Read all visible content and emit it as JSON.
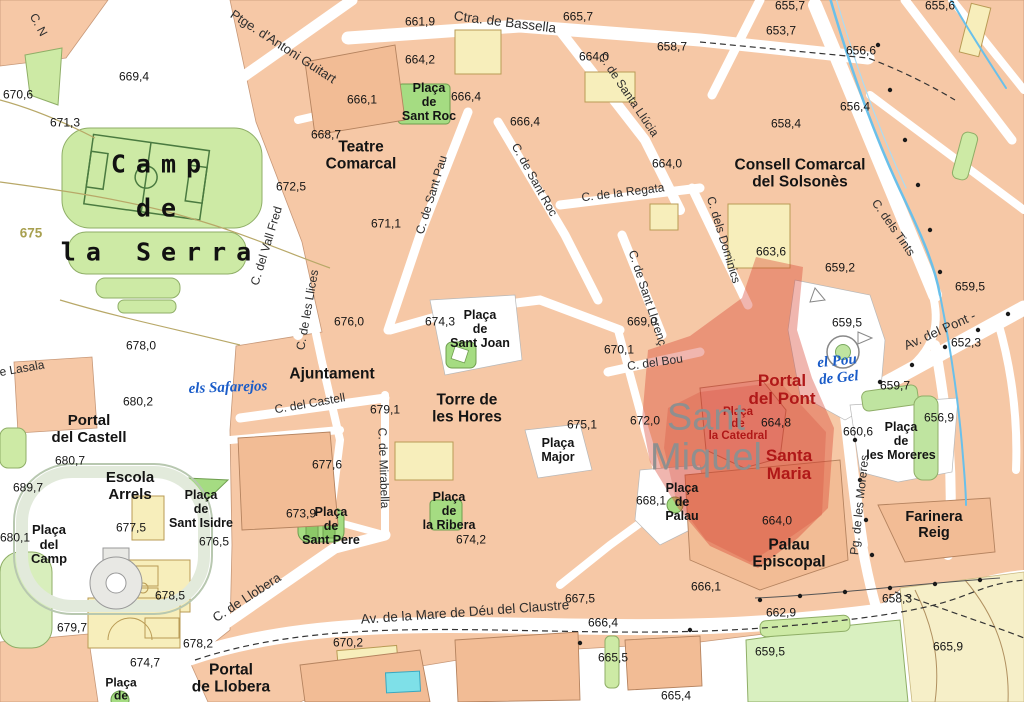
{
  "map": {
    "region_name": "Solsona old town map with highlighted cathedral area",
    "palette": {
      "block_salmon": "#f6c8a6",
      "building_yellow": "#f7eebb",
      "park_green": "#cdeaa5",
      "plaza_green": "#a5dc82",
      "water_blue": "#5fb8e8",
      "highlight_red": "#d83e2d",
      "label_red": "#b01818",
      "label_blue": "#1a5cc8",
      "label_grey": "#8f8f8f",
      "field_tan": "#f6efc8"
    },
    "highlight_label": {
      "lines": [
        "Sant",
        "Miquel"
      ],
      "x": 706,
      "y": 438,
      "s": 38
    },
    "red_labels": [
      {
        "lines": [
          "Portal",
          "del Pont"
        ],
        "x": 782,
        "y": 390,
        "s": 17
      },
      {
        "lines": [
          "Santa",
          "Maria"
        ],
        "x": 789,
        "y": 465,
        "s": 17
      },
      {
        "lines": [
          "Plaça",
          "de",
          "la Catedral"
        ],
        "x": 738,
        "y": 424,
        "s": 11.5
      }
    ],
    "water_labels": [
      {
        "lines": [
          "els Safarejos"
        ],
        "x": 228,
        "y": 388,
        "r": -2
      },
      {
        "lines": [
          "el Pou",
          "de Gel"
        ],
        "x": 838,
        "y": 370,
        "r": -6
      }
    ],
    "place_labels": [
      {
        "lines": [
          "Teatre",
          "Comarcal"
        ],
        "x": 361,
        "y": 156,
        "s": 15.5
      },
      {
        "lines": [
          "Plaça",
          "de",
          "Sant Roc"
        ],
        "x": 429,
        "y": 102,
        "s": 12.5
      },
      {
        "lines": [
          "Consell Comarcal",
          "del Solsonès"
        ],
        "x": 800,
        "y": 174,
        "s": 15.5
      },
      {
        "lines": [
          "Ajuntament"
        ],
        "x": 332,
        "y": 374,
        "s": 15.5
      },
      {
        "lines": [
          "Torre de",
          "les Hores"
        ],
        "x": 467,
        "y": 409,
        "s": 15.5
      },
      {
        "lines": [
          "Plaça",
          "Major"
        ],
        "x": 558,
        "y": 450,
        "s": 12.5
      },
      {
        "lines": [
          "Plaça",
          "de",
          "Sant Joan"
        ],
        "x": 480,
        "y": 329,
        "s": 12.5
      },
      {
        "lines": [
          "Portal",
          "del Castell"
        ],
        "x": 89,
        "y": 430,
        "s": 15
      },
      {
        "lines": [
          "Escola",
          "Arrels"
        ],
        "x": 130,
        "y": 487,
        "s": 15
      },
      {
        "lines": [
          "Plaça",
          "del",
          "Camp"
        ],
        "x": 49,
        "y": 545,
        "s": 13
      },
      {
        "lines": [
          "Plaça",
          "de",
          "Sant Isidre"
        ],
        "x": 201,
        "y": 509,
        "s": 12.5
      },
      {
        "lines": [
          "Plaça",
          "de",
          "Sant Pere"
        ],
        "x": 331,
        "y": 526,
        "s": 12.5
      },
      {
        "lines": [
          "Plaça",
          "de",
          "la Ribera"
        ],
        "x": 449,
        "y": 511,
        "s": 12.5
      },
      {
        "lines": [
          "Plaça",
          "de",
          "Palau"
        ],
        "x": 682,
        "y": 502,
        "s": 12.5
      },
      {
        "lines": [
          "Palau",
          "Episcopal"
        ],
        "x": 789,
        "y": 554,
        "s": 15.5
      },
      {
        "lines": [
          "Farinera",
          "Reig"
        ],
        "x": 934,
        "y": 525,
        "s": 14.5
      },
      {
        "lines": [
          "Plaça",
          "de",
          "les Moreres"
        ],
        "x": 901,
        "y": 441,
        "s": 12.5
      },
      {
        "lines": [
          "Portal",
          "de Llobera"
        ],
        "x": 231,
        "y": 679,
        "s": 15.5
      },
      {
        "lines": [
          "Plaça",
          "de"
        ],
        "x": 121,
        "y": 690,
        "s": 12
      }
    ],
    "serra_label": {
      "lines": [
        "Camp",
        "de",
        "la Serra"
      ],
      "x": 161,
      "y": 208
    },
    "street_labels": [
      {
        "t": "C. N",
        "x": 38,
        "y": 25,
        "r": 62
      },
      {
        "t": "Ptge. d'Antoni Guitart",
        "x": 283,
        "y": 47,
        "r": 33,
        "s": 13
      },
      {
        "t": "Ctra. de Bassella",
        "x": 505,
        "y": 22,
        "r": 7,
        "s": 13.5
      },
      {
        "t": "C. de Santa Llúcia",
        "x": 628,
        "y": 95,
        "r": 56
      },
      {
        "t": "C. de Sant Pau",
        "x": 432,
        "y": 195,
        "r": -73
      },
      {
        "t": "C. de Sant Roc",
        "x": 534,
        "y": 180,
        "r": 61
      },
      {
        "t": "C. de la Regata",
        "x": 623,
        "y": 193,
        "r": -7
      },
      {
        "t": "C. dels Dominics",
        "x": 723,
        "y": 240,
        "r": 73
      },
      {
        "t": "C. dels Tints",
        "x": 893,
        "y": 228,
        "r": 55
      },
      {
        "t": "C. del Vall Fred",
        "x": 267,
        "y": 246,
        "r": -73
      },
      {
        "t": "C. de les Llices",
        "x": 308,
        "y": 310,
        "r": -80
      },
      {
        "t": "C. de Sant Llorenç",
        "x": 647,
        "y": 298,
        "r": 72
      },
      {
        "t": "C. del Bou",
        "x": 655,
        "y": 363,
        "r": -8
      },
      {
        "t": "C. del Castell",
        "x": 310,
        "y": 404,
        "r": -10
      },
      {
        "t": "C. de Mirabella",
        "x": 383,
        "y": 468,
        "r": 88
      },
      {
        "t": "Av. del Pont -",
        "x": 940,
        "y": 331,
        "r": -24,
        "s": 13
      },
      {
        "t": "Pg. de les Moreres",
        "x": 860,
        "y": 505,
        "r": -84
      },
      {
        "t": "C. de Llobera",
        "x": 247,
        "y": 598,
        "r": -33,
        "s": 13
      },
      {
        "t": "Av. de la Mare de Déu del Claustre",
        "x": 465,
        "y": 612,
        "r": -4,
        "s": 13.5
      },
      {
        "t": "e Lasala",
        "x": 22,
        "y": 369,
        "r": -10
      }
    ],
    "elevation_labels": [
      {
        "t": "665,7",
        "x": 578,
        "y": 17
      },
      {
        "t": "661,9",
        "x": 420,
        "y": 22
      },
      {
        "t": "664,2",
        "x": 420,
        "y": 60
      },
      {
        "t": "664,0",
        "x": 594,
        "y": 57
      },
      {
        "t": "658,7",
        "x": 672,
        "y": 47
      },
      {
        "t": "655,7",
        "x": 790,
        "y": 6
      },
      {
        "t": "655,6",
        "x": 940,
        "y": 6
      },
      {
        "t": "653,7",
        "x": 781,
        "y": 31
      },
      {
        "t": "656,6",
        "x": 861,
        "y": 51
      },
      {
        "t": "656,4",
        "x": 855,
        "y": 107
      },
      {
        "t": "658,4",
        "x": 786,
        "y": 124
      },
      {
        "t": "669,4",
        "x": 134,
        "y": 77
      },
      {
        "t": "670,6",
        "x": 18,
        "y": 95
      },
      {
        "t": "671,3",
        "x": 65,
        "y": 123
      },
      {
        "t": "668,7",
        "x": 326,
        "y": 135
      },
      {
        "t": "666,1",
        "x": 362,
        "y": 100
      },
      {
        "t": "666,4",
        "x": 466,
        "y": 97
      },
      {
        "t": "666,4",
        "x": 525,
        "y": 122
      },
      {
        "t": "672,5",
        "x": 291,
        "y": 187
      },
      {
        "t": "671,1",
        "x": 386,
        "y": 224
      },
      {
        "t": "675",
        "x": 31,
        "y": 233,
        "c": "contour"
      },
      {
        "t": "676,0",
        "x": 349,
        "y": 322
      },
      {
        "t": "674,3",
        "x": 440,
        "y": 322
      },
      {
        "t": "669,0",
        "x": 642,
        "y": 322
      },
      {
        "t": "670,1",
        "x": 619,
        "y": 350
      },
      {
        "t": "664,0",
        "x": 667,
        "y": 164
      },
      {
        "t": "663,6",
        "x": 771,
        "y": 252
      },
      {
        "t": "659,2",
        "x": 840,
        "y": 268
      },
      {
        "t": "659,5",
        "x": 970,
        "y": 287
      },
      {
        "t": "659,5",
        "x": 847,
        "y": 323
      },
      {
        "t": "652,3",
        "x": 966,
        "y": 343
      },
      {
        "t": "672,0",
        "x": 645,
        "y": 421
      },
      {
        "t": "664,8",
        "x": 776,
        "y": 423
      },
      {
        "t": "679,1",
        "x": 385,
        "y": 410
      },
      {
        "t": "675,1",
        "x": 582,
        "y": 425
      },
      {
        "t": "677,6",
        "x": 327,
        "y": 465
      },
      {
        "t": "678,0",
        "x": 141,
        "y": 346
      },
      {
        "t": "680,2",
        "x": 138,
        "y": 402
      },
      {
        "t": "680,7",
        "x": 70,
        "y": 461
      },
      {
        "t": "689,7",
        "x": 28,
        "y": 488
      },
      {
        "t": "680,1",
        "x": 15,
        "y": 538
      },
      {
        "t": "677,5",
        "x": 131,
        "y": 528
      },
      {
        "t": "676,5",
        "x": 214,
        "y": 542
      },
      {
        "t": "678,5",
        "x": 170,
        "y": 596
      },
      {
        "t": "673,9",
        "x": 301,
        "y": 514
      },
      {
        "t": "674,2",
        "x": 471,
        "y": 540
      },
      {
        "t": "668,1",
        "x": 651,
        "y": 501
      },
      {
        "t": "660,6",
        "x": 858,
        "y": 432
      },
      {
        "t": "659,7",
        "x": 895,
        "y": 386
      },
      {
        "t": "656,9",
        "x": 939,
        "y": 418
      },
      {
        "t": "664,0",
        "x": 777,
        "y": 521
      },
      {
        "t": "666,1",
        "x": 706,
        "y": 587
      },
      {
        "t": "667,5",
        "x": 580,
        "y": 599
      },
      {
        "t": "666,4",
        "x": 603,
        "y": 623
      },
      {
        "t": "665,5",
        "x": 613,
        "y": 658
      },
      {
        "t": "665,4",
        "x": 676,
        "y": 696
      },
      {
        "t": "662,9",
        "x": 781,
        "y": 613
      },
      {
        "t": "659,5",
        "x": 770,
        "y": 652
      },
      {
        "t": "658,3",
        "x": 897,
        "y": 599
      },
      {
        "t": "665,9",
        "x": 948,
        "y": 647
      },
      {
        "t": "679,7",
        "x": 72,
        "y": 628
      },
      {
        "t": "674,7",
        "x": 145,
        "y": 663
      },
      {
        "t": "678,2",
        "x": 198,
        "y": 644
      },
      {
        "t": "670,2",
        "x": 348,
        "y": 643
      }
    ]
  }
}
